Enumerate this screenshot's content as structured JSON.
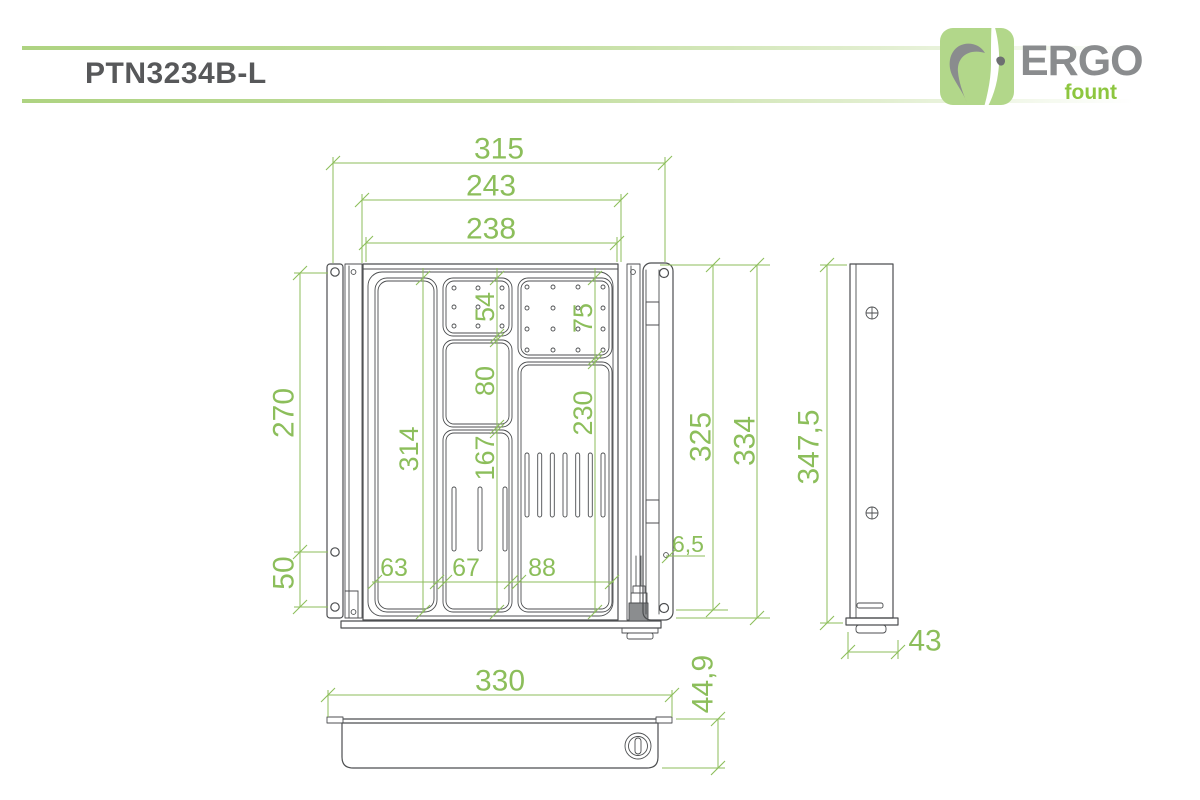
{
  "title": "PTN3234B-L",
  "logo": {
    "brand": "ERGO",
    "tagline": "fount"
  },
  "colors": {
    "dimension_green": "#8cbe5b",
    "header_line_green": "#aed381",
    "logo_badge_green": "#b2d78a",
    "logo_brand_gray": "#8a8c8e",
    "logo_tagline_green": "#8dc63f",
    "drawing_line_gray": "#4c4e50",
    "title_gray": "#57585a"
  },
  "views": {
    "front": {
      "dims": {
        "overall_width": "315",
        "body_width": "243",
        "tray_width": "238",
        "left_hole_span_upper": "270",
        "left_hole_span_lower": "50",
        "left_compartment_height": "314",
        "small_compartment_height": "54",
        "pinboard_height": "75",
        "mid_compartment_height": "80",
        "right_compartment_height": "230",
        "pen_compartment_height": "167",
        "left_compartment_width": "63",
        "mid_compartment_width": "67",
        "right_compartment_width": "88",
        "bracket_inner_height": "325",
        "bracket_height": "334",
        "hole_diameter": "6,5"
      }
    },
    "side": {
      "dims": {
        "height": "347,5",
        "depth": "43"
      }
    },
    "bottom": {
      "dims": {
        "width": "330",
        "depth": "44,9"
      }
    }
  }
}
